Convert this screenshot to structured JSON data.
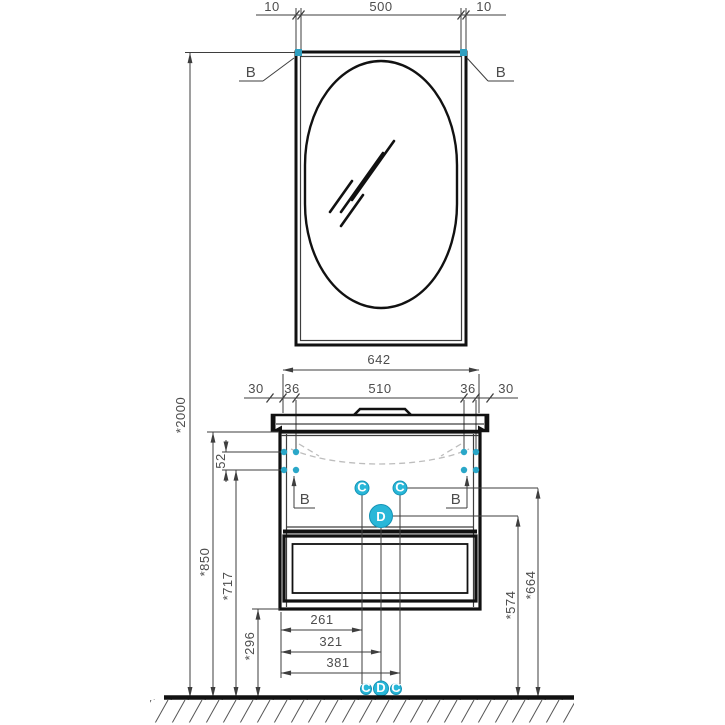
{
  "drawing": {
    "background": "#ffffff",
    "accent_color": "#29b7d8",
    "line_color": "#3e3e3e",
    "mirror": {
      "frame_thickness_left": "10",
      "glass_width": "500",
      "frame_thickness_right": "10",
      "callout_top_left": "B",
      "callout_top_right": "B"
    },
    "overall": {
      "total_height": "*2000"
    },
    "vanity": {
      "top_width": "642",
      "overhang_left": "30",
      "inset_left": "36",
      "hole_span": "510",
      "inset_right": "36",
      "overhang_right": "30",
      "hole_row_gap": "52",
      "height_worktop": "*850",
      "height_holes": "*717",
      "height_underside": "*296",
      "callout_holes_left": "B",
      "callout_holes_right": "B",
      "outlet_left": "C",
      "outlet_right": "C",
      "drain": "D",
      "offset_outlet_left": "261",
      "offset_drain": "321",
      "offset_outlet_right": "381",
      "height_drain": "*574",
      "height_outlets": "*664",
      "floor_marker_left": "C",
      "floor_marker_center": "D",
      "floor_marker_right": "C"
    }
  }
}
